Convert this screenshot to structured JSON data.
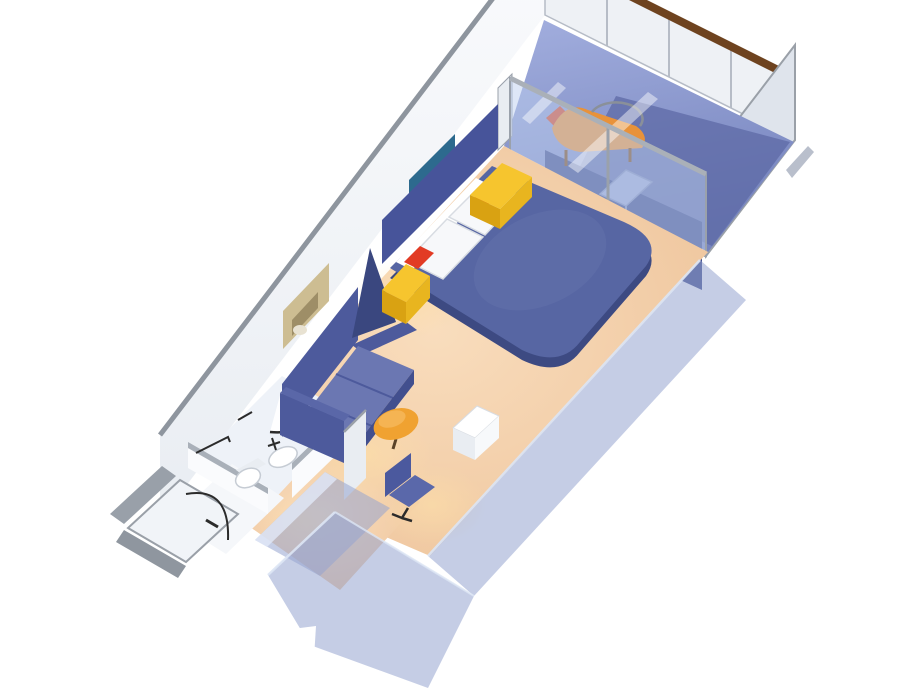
{
  "scene": {
    "name": "cruise-stateroom-isometric-floorplan",
    "view": "isometric-cutaway-3d-render",
    "rooms": [
      {
        "id": "entry",
        "label": "Entry"
      },
      {
        "id": "bathroom",
        "label": "Bathroom"
      },
      {
        "id": "bedroom",
        "label": "Bedroom / Sitting Area"
      },
      {
        "id": "balcony",
        "label": "Private Balcony"
      }
    ],
    "elements": [
      {
        "id": "entry-door",
        "label": "Entry door"
      },
      {
        "id": "shower",
        "label": "Curved shower"
      },
      {
        "id": "sink",
        "label": "Vanity sink"
      },
      {
        "id": "toilet",
        "label": "Toilet"
      },
      {
        "id": "wardrobe",
        "label": "Wardrobe / closet units"
      },
      {
        "id": "desk-chair",
        "label": "Desk chair"
      },
      {
        "id": "cabinet",
        "label": "White cabinet"
      },
      {
        "id": "ottoman",
        "label": "Round ottoman"
      },
      {
        "id": "sofa",
        "label": "Sofa"
      },
      {
        "id": "sail-divider",
        "label": "Sail-shaped divider"
      },
      {
        "id": "bed",
        "label": "Queen bed"
      },
      {
        "id": "nightstands",
        "label": "Yellow nightstands with red cushions"
      },
      {
        "id": "wall-art",
        "label": "Two framed wall artworks"
      },
      {
        "id": "glass-door",
        "label": "Sliding glass balcony door"
      },
      {
        "id": "lounge-chair",
        "label": "Balcony lounge chair"
      },
      {
        "id": "balcony-table",
        "label": "Balcony side table"
      },
      {
        "id": "railing",
        "label": "Balcony railing with wood cap"
      },
      {
        "id": "partition",
        "label": "Balcony privacy partition"
      }
    ]
  },
  "colors": {
    "background": "#ffffff",
    "wall_white": "#fafbfd",
    "wall_shade": "#e9edf2",
    "wall_top": "#8e959e",
    "slab_top": "#a9b0b9",
    "carpet_light": "#f9ddbd",
    "carpet": "#eec49b",
    "bathroom_floor": "#eef2f8",
    "vestibule_floor": "#f5f7fa",
    "headboard": "#47549a",
    "bed_spread": "#5766a3",
    "bed_sheen": "#6673ae",
    "bed_side": "#3d4a82",
    "pillow": "#f7f8fa",
    "pillow_stroke": "#d8dce2",
    "nightstand_top": "#f6c52e",
    "nightstand_side": "#d9a212",
    "nightstand_front": "#e8b51f",
    "cushion_red": "#e23b24",
    "sofa_base": "#4d5a9c",
    "sofa_seat": "#6b77b2",
    "sofa_arm_top": "#5a67a8",
    "sofa_skirt": "#424f8e",
    "sail_navy": "#3a477f",
    "ottoman": "#f0a231",
    "ottoman_sheen": "#f6b95c",
    "ottoman_leg": "#5a4328",
    "chair_back": "#4b599e",
    "chair_seat": "#5a68aa",
    "cabinet_top": "#ffffff",
    "cabinet_left": "#e9edf2",
    "cabinet_right": "#f7f9fb",
    "deck_light": "#a2aede",
    "deck_blue": "#7583bd",
    "deck_shadow": "#5d6aa6",
    "wall_navy": "#404e8e",
    "glass_tint": "rgba(190,208,240,0.5)",
    "glass_streak": "#ffffff",
    "glass_frame": "#9aa1ab",
    "glass_track": "#aab0b8",
    "jamb": "#e9edf2",
    "rail_white": "#eef1f5",
    "rail_line": "#b6bcc6",
    "rail_cap_wood": "#6e431f",
    "partition_gray": "#dfe4ec",
    "partition_back": "#b9bfcc",
    "partition_stroke": "#9aa0a8",
    "translucent_wall": "rgba(150,164,208,0.55)",
    "translucent_top": "rgba(225,232,248,0.8)",
    "translucent_edge": "#dde6f5",
    "art_reef_bg": "#2d6a8e",
    "art_reef_green": "#3f8f5c",
    "art_reef_red": "#c2452f",
    "art_reef_yellow": "#d8a43c",
    "art_tan": "#cdbd92",
    "art_tan_inner": "#8a7a55",
    "art_tan_light": "#e8e2d2",
    "lounger_wood": "#e8923a",
    "lounger_red": "#d84a28",
    "lounger_leg": "#7a4c20",
    "hoop_metal": "#8a9099",
    "table_top": "#9aa6d2",
    "table_stroke": "#7f8cbb",
    "fixture_white": "#ffffff",
    "fixture_stroke": "#c6ccd4",
    "dark_line": "#2b2b2b",
    "glow": "#ffe2a8",
    "door_slab": "#f1f4f8",
    "corner_slab": "#99a0a9",
    "corner_slab2": "#8f969f"
  }
}
